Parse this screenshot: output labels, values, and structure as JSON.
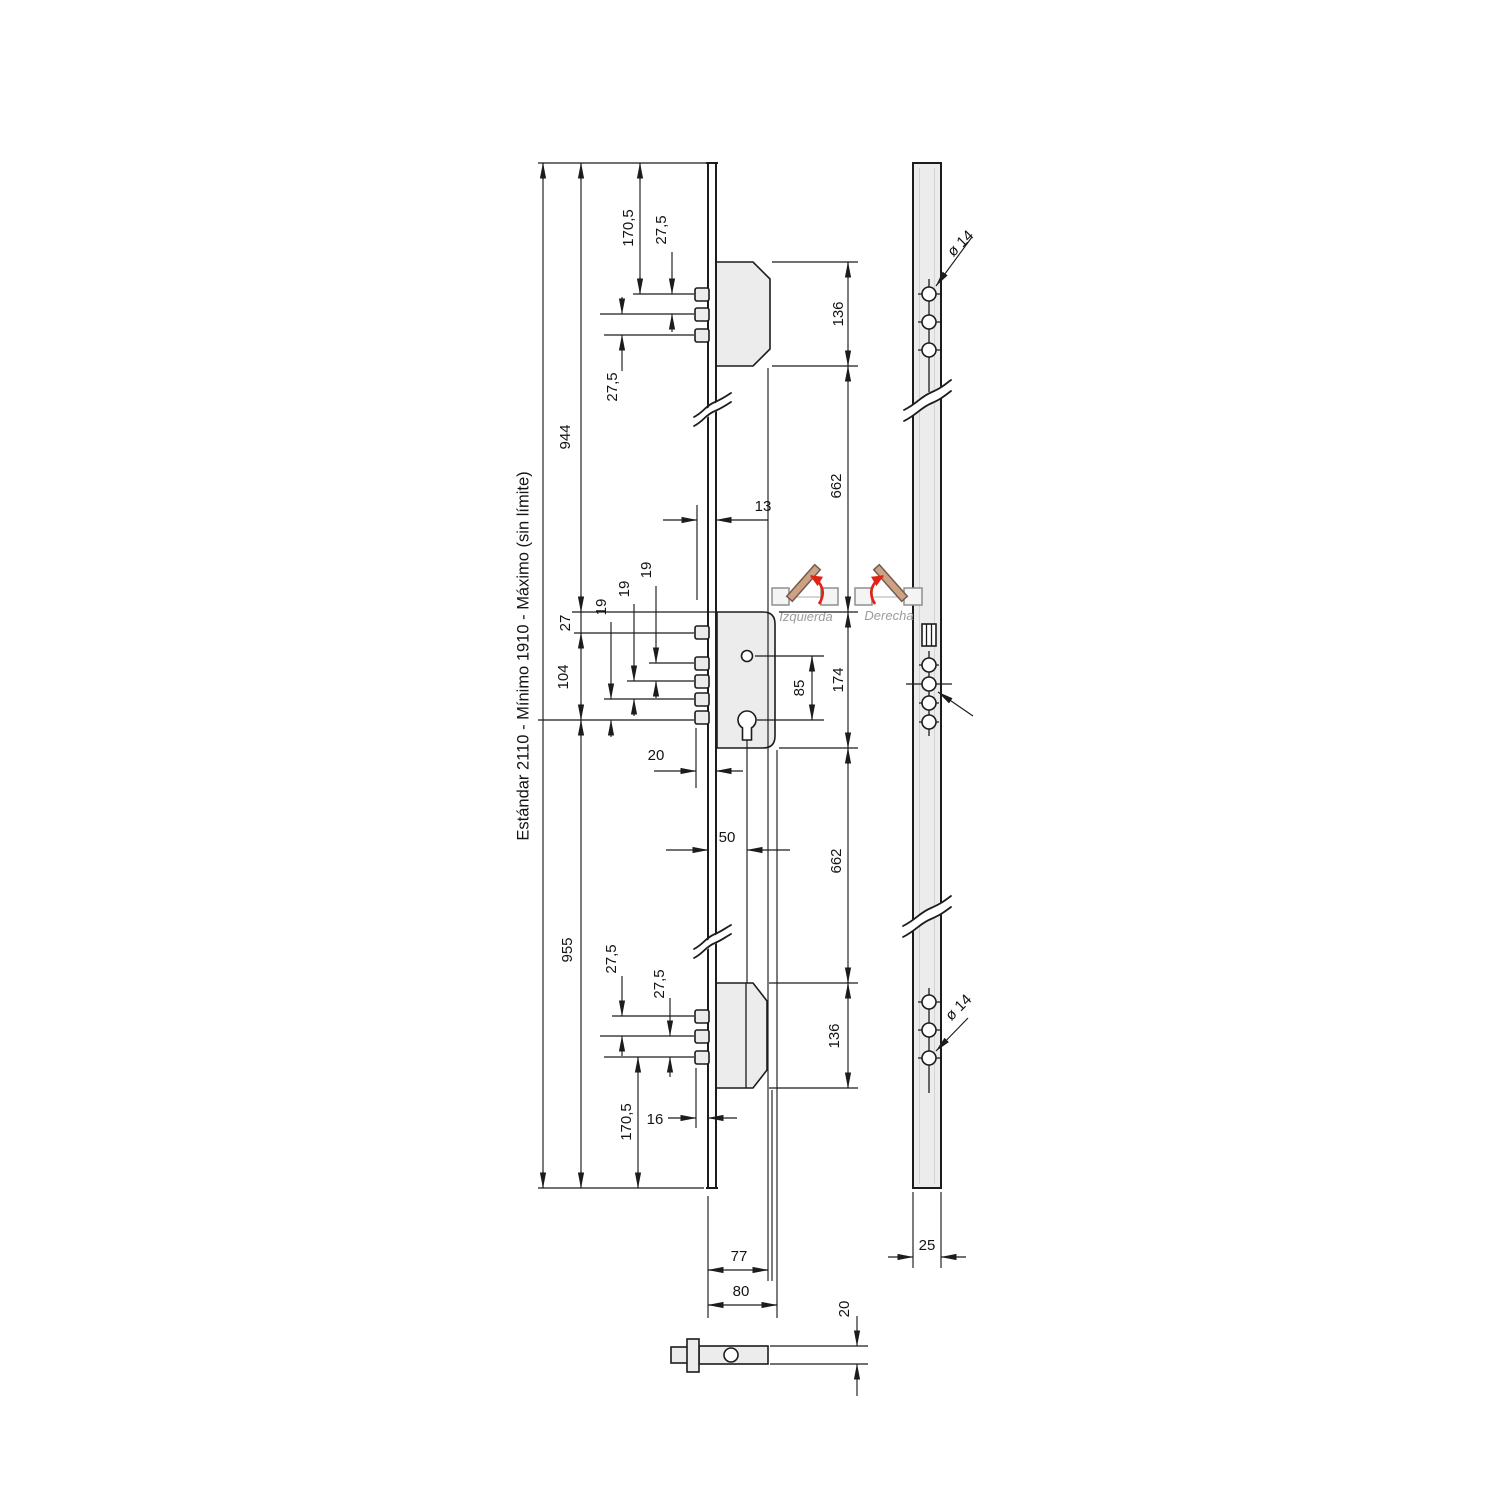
{
  "note": {
    "spec": "Estándar 2110 - Mínimo 1910 - Máximo (sin límite)"
  },
  "handing": {
    "left": "Izquierda",
    "right": "Derecha"
  },
  "dims": {
    "left_total_top": "944",
    "left_total_bottom": "955",
    "top_offset": "170,5",
    "top_pitch_a": "27,5",
    "top_pitch_b": "27,5",
    "top_box_height": "136",
    "upper_gap": "662",
    "face_offset": "13",
    "case_top_offset": "27",
    "case_bolt_span": "104",
    "bolt_pitch_a": "19",
    "bolt_pitch_b": "19",
    "bolt_pitch_c": "19",
    "bolt_throw": "20",
    "backset": "50",
    "centers": "85",
    "case_height": "174",
    "lower_gap": "662",
    "bottom_box_height": "136",
    "bottom_pitch_a": "27,5",
    "bottom_pitch_b": "27,5",
    "bottom_offset": "170,5",
    "bottom_throw": "16",
    "body_depth": "77",
    "body_depth_total": "80",
    "strip_width": "25",
    "spindle_size": "20",
    "hole_dia_top": "ø 14",
    "hole_dia_bottom": "ø 14"
  }
}
